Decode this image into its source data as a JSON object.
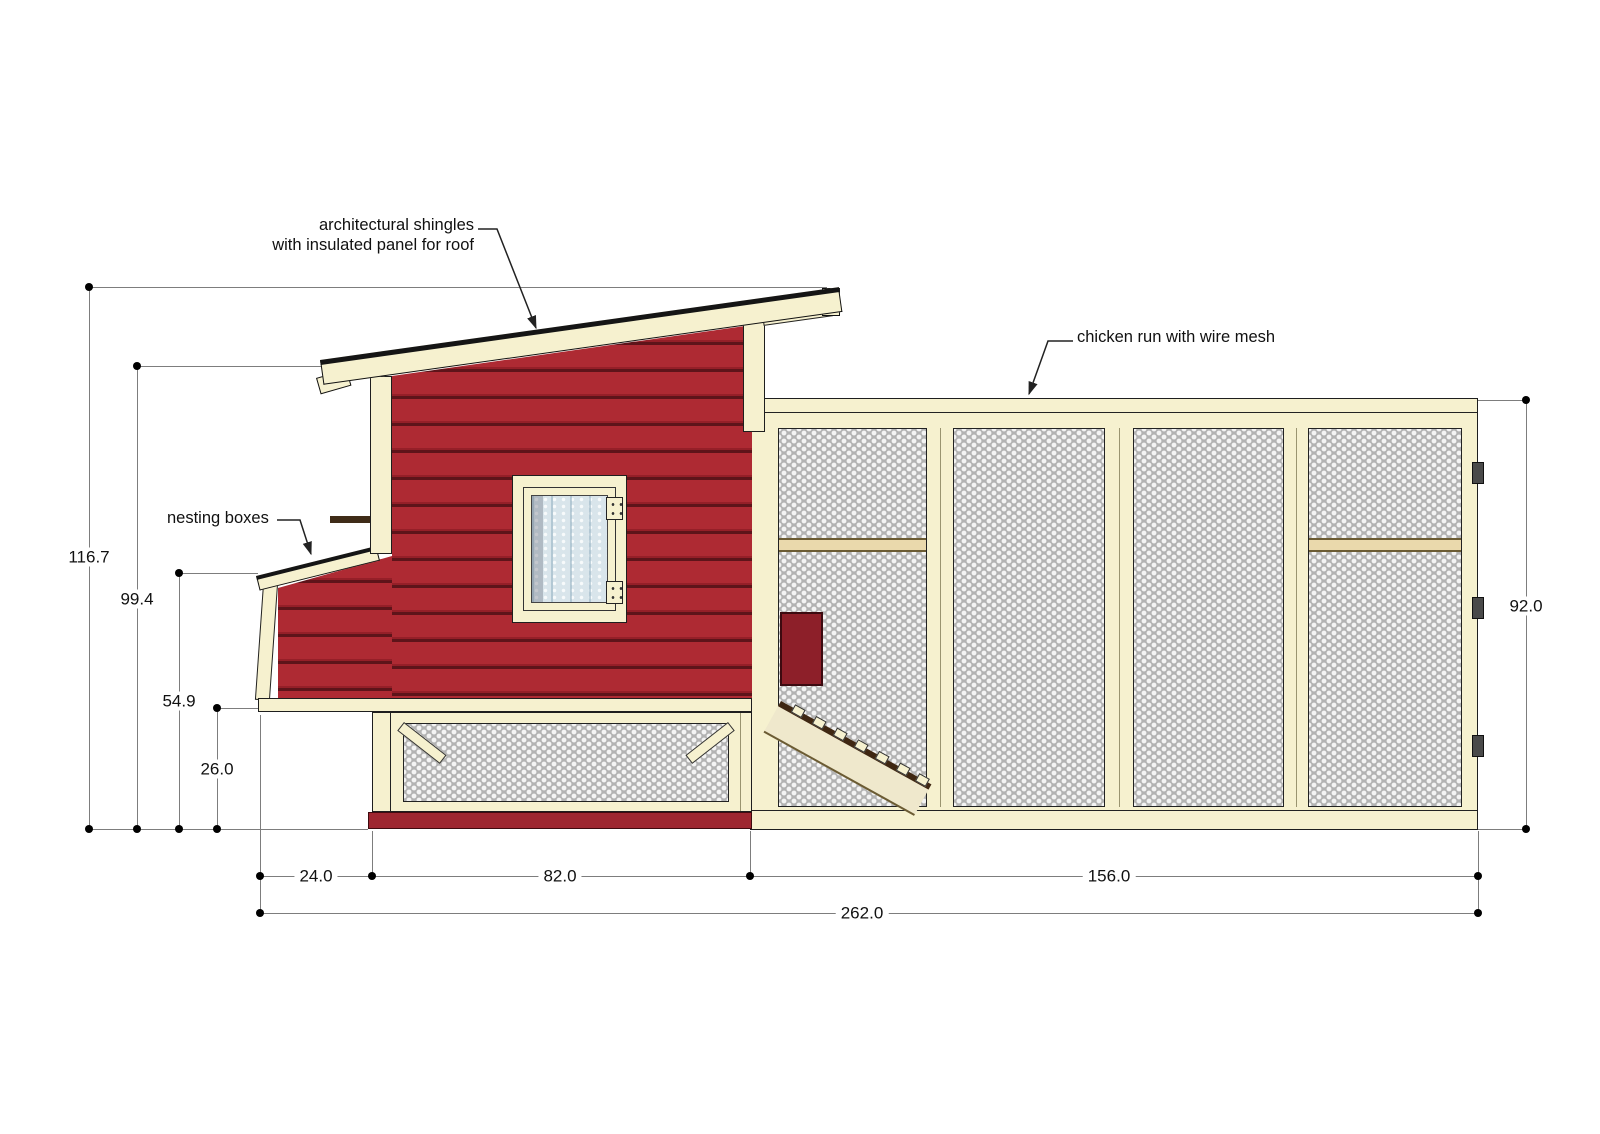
{
  "drawing": {
    "type": "elevation-plan",
    "subject": "chicken coop with run, side elevation with dimensions"
  },
  "annotations": {
    "roof_line1": "architectural shingles",
    "roof_line2": "with insulated panel for roof",
    "nesting": "nesting boxes",
    "run": "chicken run with wire mesh"
  },
  "dims": {
    "total_height": "116.7",
    "coop_roof_height": "99.4",
    "nest_roof_height": "54.9",
    "floor_height": "26.0",
    "run_height": "92.0",
    "nest_depth": "24.0",
    "coop_width": "82.0",
    "run_width": "156.0",
    "total_width": "262.0"
  },
  "colors": {
    "wall_red": "#ae2a33",
    "frame_cream": "#f6f1cf",
    "mesh_gray": "#b3b3b3",
    "shingle_dark": "#151515",
    "glass_blue": "#d9e5eb",
    "roost_tan": "#ead9ac",
    "skid_red": "#9e2630"
  }
}
